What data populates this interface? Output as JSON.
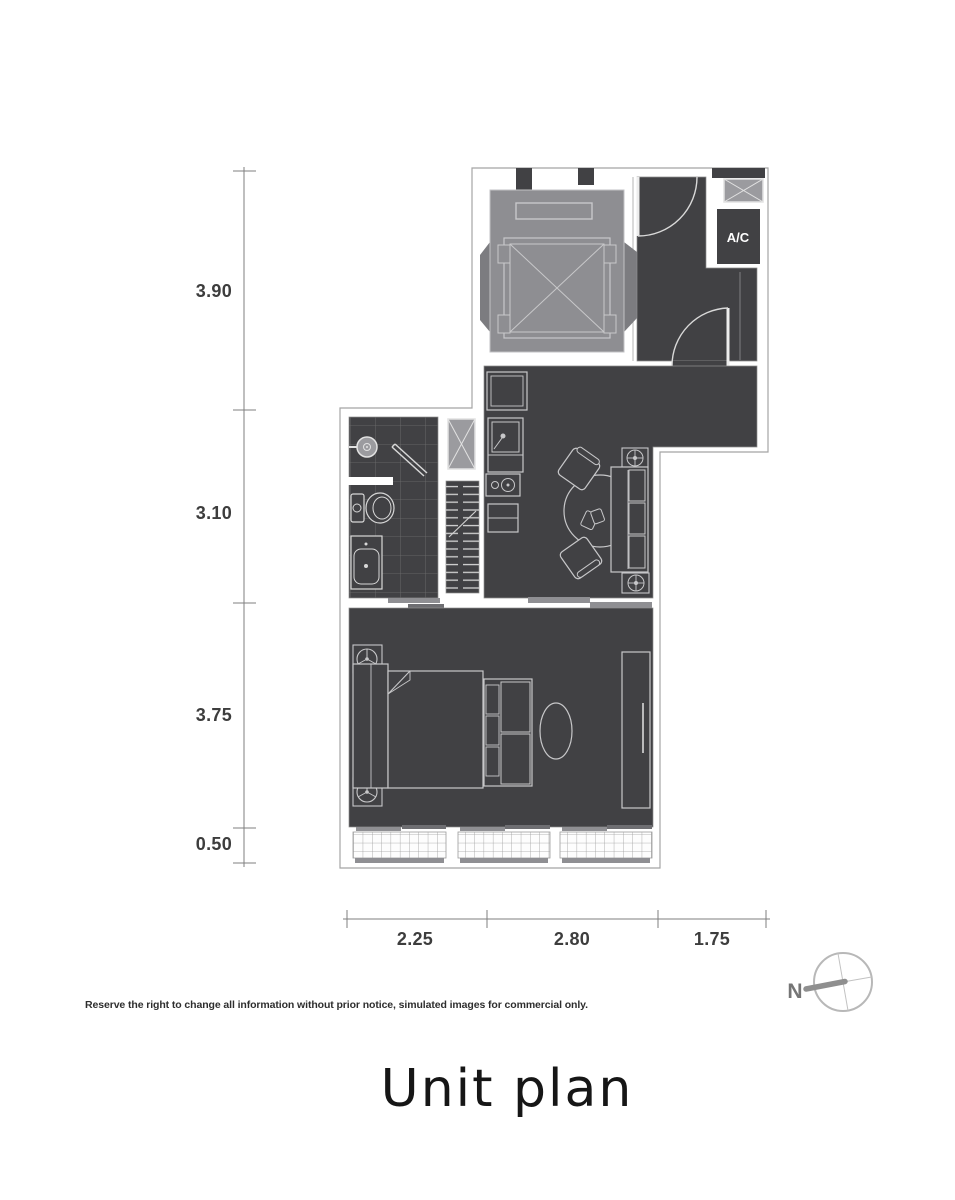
{
  "page": {
    "title": "Unit plan",
    "disclaimer": "Reserve the right to change all information without prior notice, simulated images for commercial only."
  },
  "plan": {
    "ac_label": "A/C"
  },
  "dimensions": {
    "vertical": [
      "3.90",
      "3.10",
      "3.75",
      "0.50"
    ],
    "horizontal": [
      "2.25",
      "2.80",
      "1.75"
    ]
  },
  "compass": {
    "north_label": "N"
  },
  "colors": {
    "floor_dark": "#414144",
    "core_gray": "#8e8e92",
    "hatch_gray": "#9b9b9f",
    "furniture_line": "#c7c7c9",
    "wall_outline": "#a5a5a5",
    "dim_line": "#7f7f7f",
    "dim_text": "#3d3d3d",
    "ac_text": "#ffffff"
  }
}
